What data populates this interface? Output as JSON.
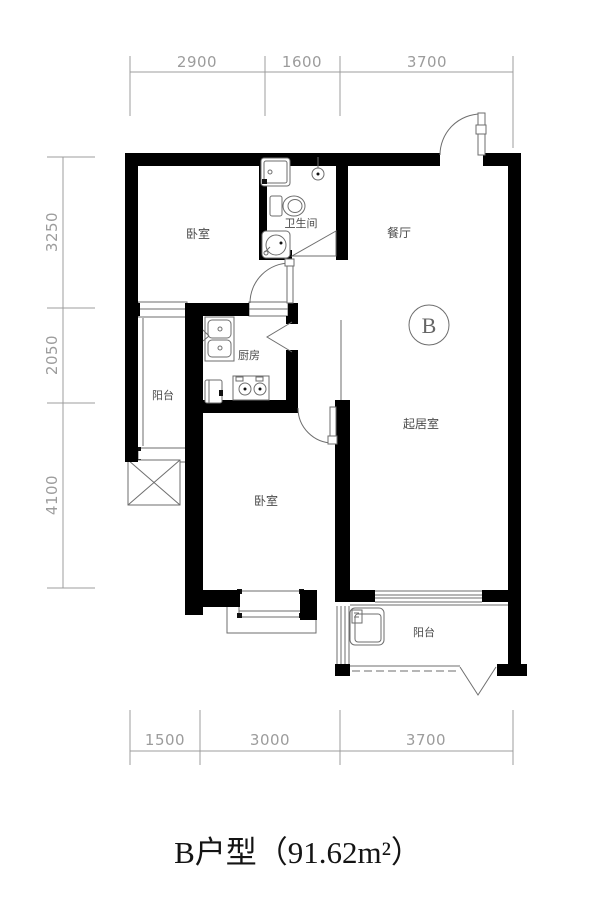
{
  "title": {
    "text": "B户型（91.62m²）"
  },
  "unit_badge": {
    "letter": "B"
  },
  "rooms": {
    "bedroom1": "卧室",
    "bathroom": "卫生间",
    "dining": "餐厅",
    "kitchen": "厨房",
    "balcony_west": "阳台",
    "living": "起居室",
    "bedroom2": "卧室",
    "balcony_south": "阳台"
  },
  "dimensions": {
    "top": [
      "2900",
      "1600",
      "3700"
    ],
    "left": [
      "3250",
      "2050",
      "4100"
    ],
    "bottom": [
      "1500",
      "3000",
      "3700"
    ]
  },
  "colors": {
    "wall": "#000000",
    "line": "#6e6e6e",
    "dim": "#9c9c9c",
    "label": "#4a4a4a",
    "bg": "#ffffff"
  }
}
